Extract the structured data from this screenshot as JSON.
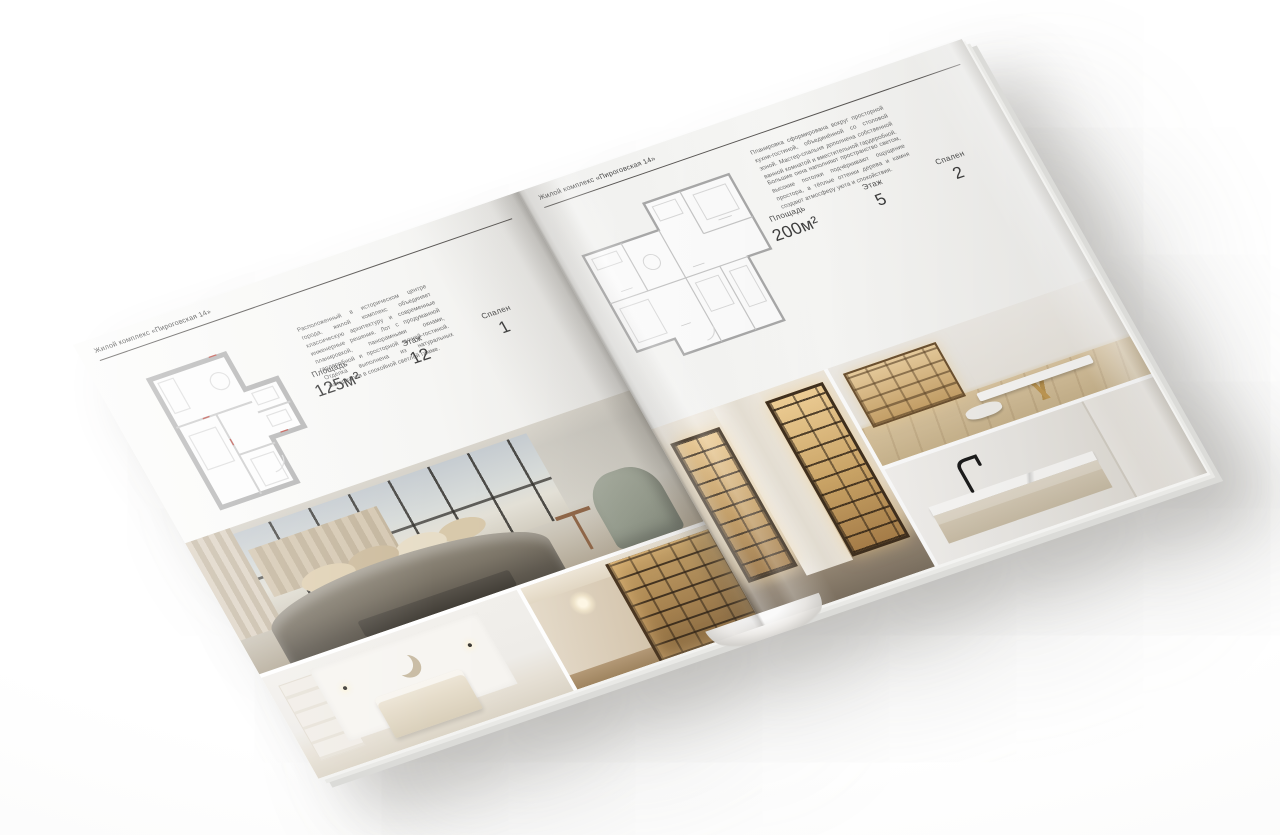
{
  "brochure": {
    "title": "Жилой комплекс «Пироговская 14»",
    "left_page": {
      "header": "Жилой комплекс «Пироговская 14»",
      "description": "Расположенный в историческом центре города, жилой комплекс объединяет классическую архитектуру и современные инженерные решения. Лот с продуманной планировкой, панорамными окнами, гардеробной и просторной кухней-гостиной. Отделка выполнена из натуральных материалов в спокойной светлой гамме.",
      "stats": {
        "area_label": "Площадь",
        "area_value": "125м²",
        "floor_label": "Этаж",
        "floor_value": "12",
        "bedrooms_label": "Спален",
        "bedrooms_value": "1"
      }
    },
    "right_page": {
      "header": "Жилой комплекс «Пироговская 14»",
      "description_1": "Планировка сформирована вокруг просторной кухни-гостиной, объединённой со столовой зоной. Мастер-спальня дополнена собственной ванной комнатой и вместительной гардеробной.",
      "description_2": "Большие окна наполняют пространство светом, высокие потолки подчёркивают ощущение простора, а тёплые оттенки дерева и камня создают атмосферу уюта и спокойствия.",
      "stats": {
        "area_label": "Площадь",
        "area_value": "200м²",
        "floor_label": "Этаж",
        "floor_value": "5",
        "bedrooms_label": "Спален",
        "bedrooms_value": "2"
      }
    },
    "colors": {
      "paper": "#f7f6f4",
      "ink": "#3e3e3e",
      "plan_wall_gray": "#b7b7b7",
      "plan_accent_red": "#c2574f",
      "backdrop": "#ffffff"
    }
  }
}
